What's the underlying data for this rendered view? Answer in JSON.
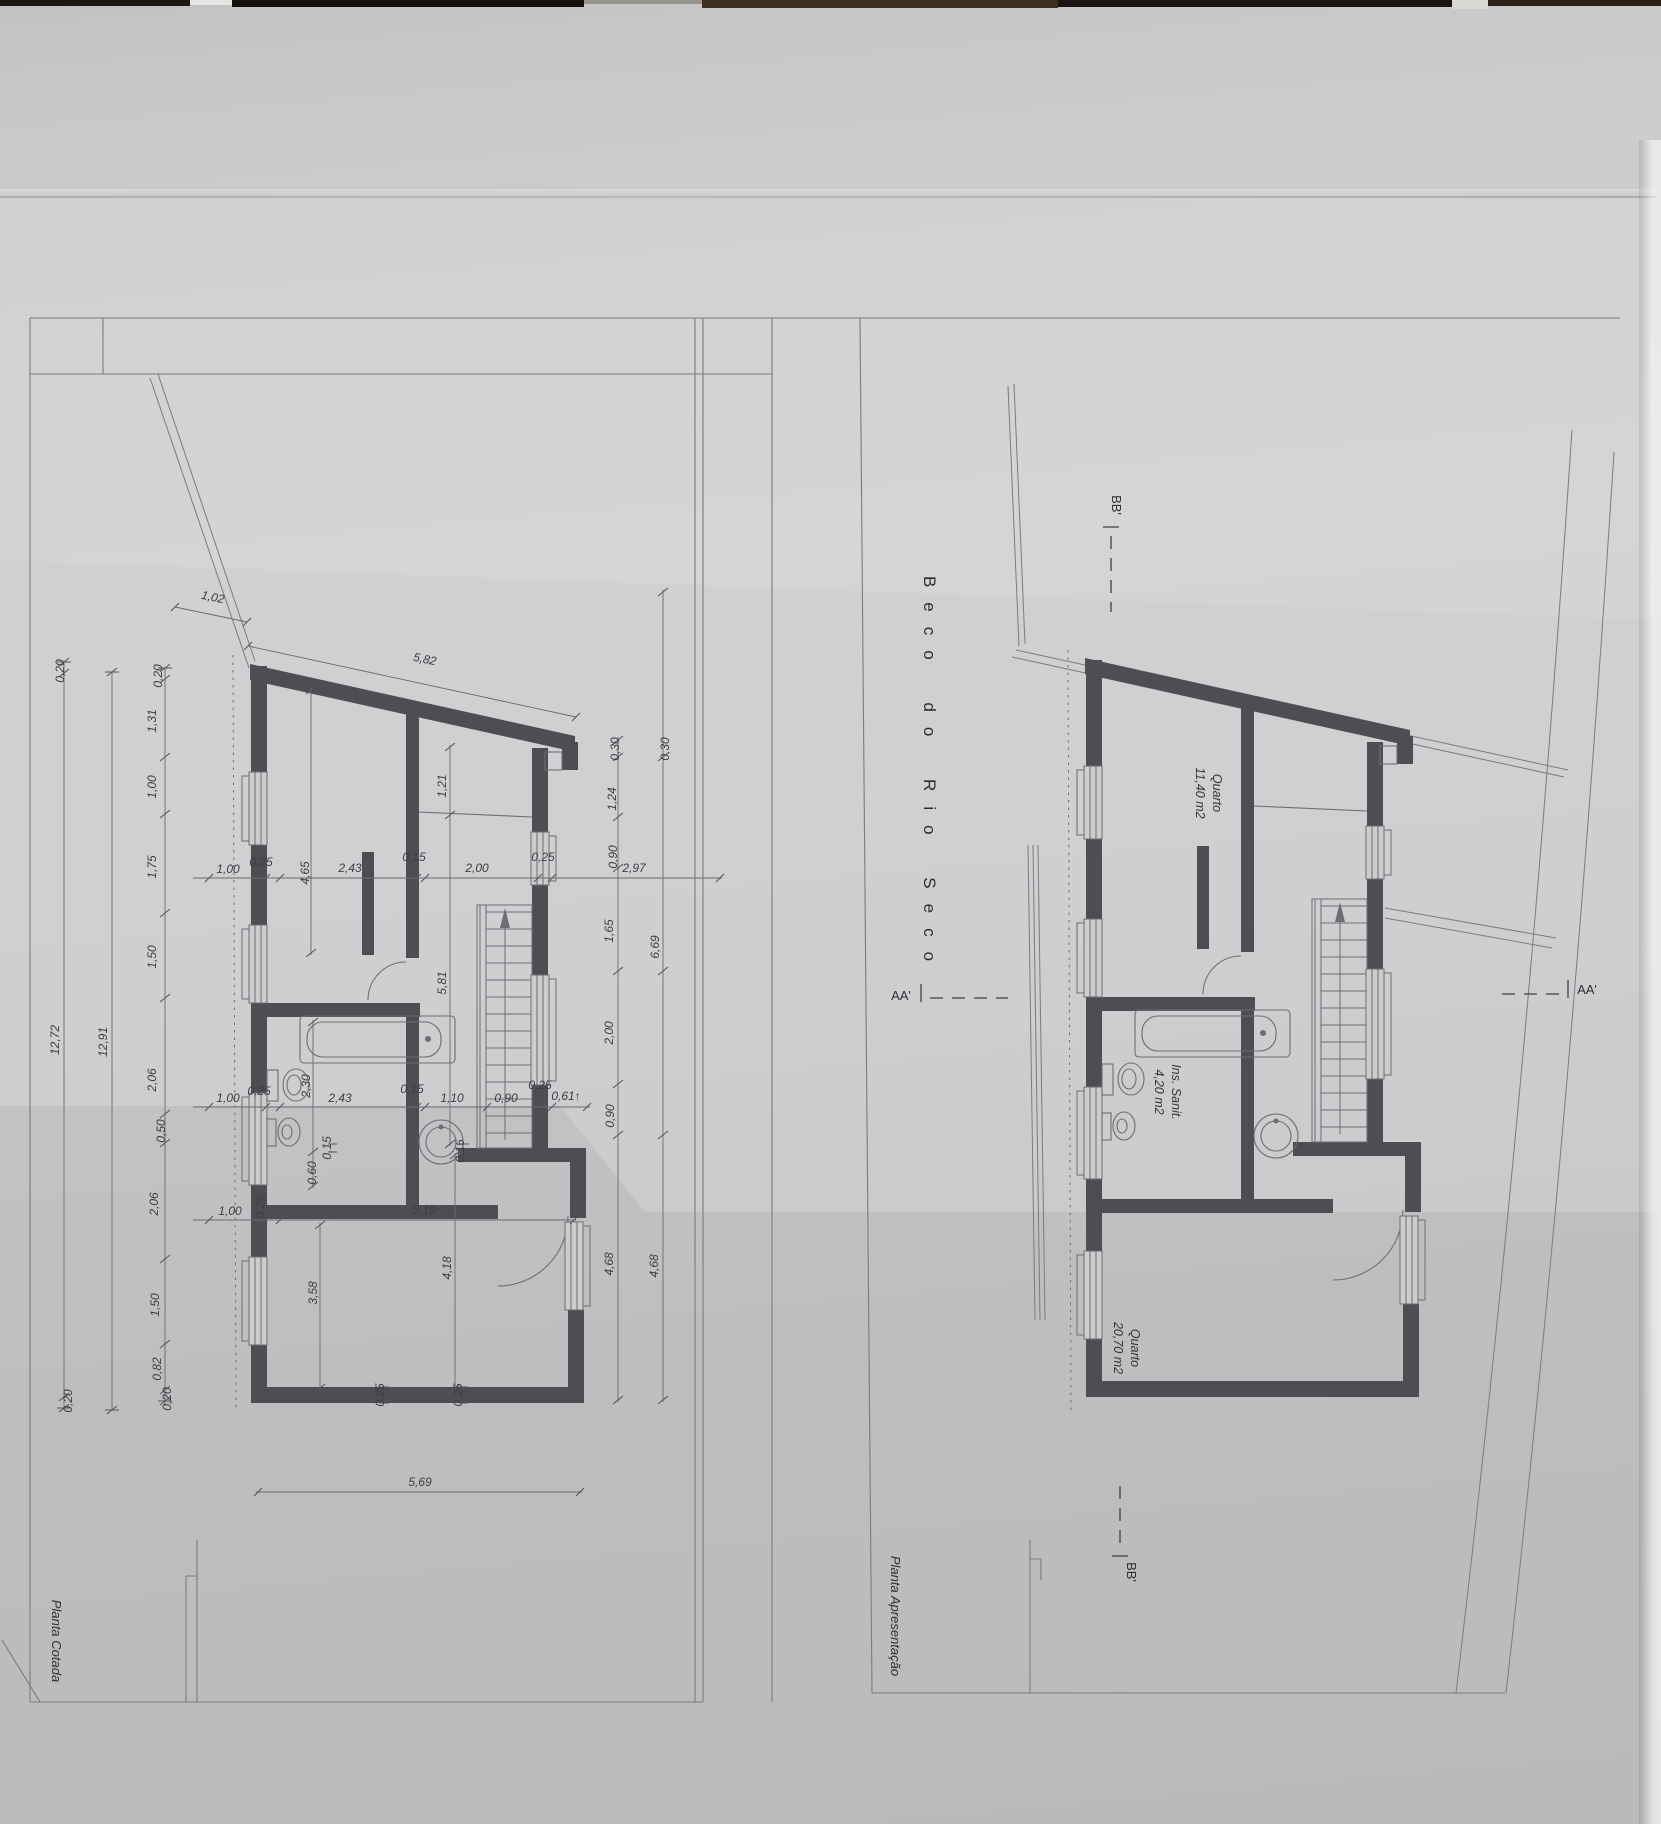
{
  "meta": {
    "street": "Beco do Rio Seco",
    "plan_left_title": "Planta Cotada",
    "plan_right_title": "Planta Apresentação"
  },
  "rooms": [
    {
      "name": "Quarto",
      "area": "11,40 m2"
    },
    {
      "name": "Ins. Sanit.",
      "area": "4,20 m2"
    },
    {
      "name": "Quarto",
      "area": "20,70 m2"
    }
  ],
  "sections": [
    "AA'",
    "BB'"
  ],
  "colors": {
    "paper": "#cdcdcf",
    "wall": "#4d4d52",
    "line": "#6d6d72",
    "dim_line": "#6a6a6f",
    "text": "#3d3d42"
  },
  "dims": [
    {
      "t": "1,02",
      "x": 212,
      "y": 601,
      "r": 12
    },
    {
      "t": "5,82",
      "x": 424,
      "y": 663,
      "r": 12
    },
    {
      "t": "0,20",
      "x": 162,
      "y": 676,
      "r": -90
    },
    {
      "t": "1,31",
      "x": 156,
      "y": 721,
      "r": -90
    },
    {
      "t": "1,00",
      "x": 156,
      "y": 787,
      "r": -90
    },
    {
      "t": "1,75",
      "x": 156,
      "y": 867,
      "r": -90
    },
    {
      "t": "1,50",
      "x": 156,
      "y": 957,
      "r": -90
    },
    {
      "t": "2,06",
      "x": 156,
      "y": 1080,
      "r": -90
    },
    {
      "t": "0,50",
      "x": 165,
      "y": 1131,
      "r": -90
    },
    {
      "t": "2,06",
      "x": 158,
      "y": 1204,
      "r": -90
    },
    {
      "t": "1,50",
      "x": 159,
      "y": 1305,
      "r": -90
    },
    {
      "t": "0,82",
      "x": 161,
      "y": 1369,
      "r": -90
    },
    {
      "t": "0,20",
      "x": 171,
      "y": 1399,
      "r": -90
    },
    {
      "t": "12,91",
      "x": 107,
      "y": 1042,
      "r": -90
    },
    {
      "t": "0,20",
      "x": 64,
      "y": 671,
      "r": -90
    },
    {
      "t": "12,72",
      "x": 59,
      "y": 1040,
      "r": -90
    },
    {
      "t": "0,20",
      "x": 72,
      "y": 1401,
      "r": -90
    },
    {
      "t": "1,00",
      "x": 228,
      "y": 873,
      "r": 0
    },
    {
      "t": "0,25",
      "x": 261,
      "y": 866,
      "r": 0
    },
    {
      "t": "4,65",
      "x": 309,
      "y": 873,
      "r": -90
    },
    {
      "t": "2,43",
      "x": 350,
      "y": 872,
      "r": 0
    },
    {
      "t": "0,15",
      "x": 414,
      "y": 861,
      "r": 0
    },
    {
      "t": "2,00",
      "x": 477,
      "y": 872,
      "r": 0
    },
    {
      "t": "0,25",
      "x": 543,
      "y": 861,
      "r": 0
    },
    {
      "t": "2,97",
      "x": 634,
      "y": 872,
      "r": 0
    },
    {
      "t": "0,30",
      "x": 619,
      "y": 749,
      "r": -90
    },
    {
      "t": "0,30",
      "x": 669,
      "y": 749,
      "r": -90
    },
    {
      "t": "1,24",
      "x": 616,
      "y": 799,
      "r": -90
    },
    {
      "t": "0,90",
      "x": 617,
      "y": 857,
      "r": -90
    },
    {
      "t": "1,65",
      "x": 613,
      "y": 931,
      "r": -90
    },
    {
      "t": "6,69",
      "x": 659,
      "y": 947,
      "r": -90
    },
    {
      "t": "2,00",
      "x": 613,
      "y": 1033,
      "r": -90
    },
    {
      "t": "0,90",
      "x": 614,
      "y": 1116,
      "r": -90
    },
    {
      "t": "4,68",
      "x": 613,
      "y": 1264,
      "r": -90
    },
    {
      "t": "4,68",
      "x": 658,
      "y": 1266,
      "r": -90
    },
    {
      "t": "1,21",
      "x": 446,
      "y": 786,
      "r": -90
    },
    {
      "t": "5,81",
      "x": 446,
      "y": 983,
      "r": -90
    },
    {
      "t": "2,30",
      "x": 310,
      "y": 1086,
      "r": -90
    },
    {
      "t": "0,15",
      "x": 331,
      "y": 1148,
      "r": -90
    },
    {
      "t": "0,60",
      "x": 316,
      "y": 1173,
      "r": -90
    },
    {
      "t": "3,58",
      "x": 317,
      "y": 1293,
      "r": -90
    },
    {
      "t": "4,18",
      "x": 451,
      "y": 1268,
      "r": -90
    },
    {
      "t": "0,15",
      "x": 464,
      "y": 1151,
      "r": -90
    },
    {
      "t": "1,00",
      "x": 228,
      "y": 1102,
      "r": 0
    },
    {
      "t": "0,25",
      "x": 259,
      "y": 1095,
      "r": 0
    },
    {
      "t": "2,43",
      "x": 340,
      "y": 1102,
      "r": 0
    },
    {
      "t": "0,15",
      "x": 412,
      "y": 1093,
      "r": 0
    },
    {
      "t": "1,10",
      "x": 452,
      "y": 1102,
      "r": 0
    },
    {
      "t": "0,90",
      "x": 506,
      "y": 1102,
      "r": 0
    },
    {
      "t": "0,25",
      "x": 540,
      "y": 1089,
      "r": 0
    },
    {
      "t": "0,61↑",
      "x": 566,
      "y": 1100,
      "r": 0
    },
    {
      "t": "1,00",
      "x": 230,
      "y": 1215,
      "r": 0
    },
    {
      "t": "0,25",
      "x": 264,
      "y": 1207,
      "r": -90
    },
    {
      "t": "5,19",
      "x": 424,
      "y": 1214,
      "r": 0
    },
    {
      "t": "0,25",
      "x": 384,
      "y": 1395,
      "r": -90
    },
    {
      "t": "0,25",
      "x": 462,
      "y": 1395,
      "r": -90
    },
    {
      "t": "5,69",
      "x": 420,
      "y": 1486,
      "r": 0
    }
  ],
  "labels": [
    {
      "t": "Beco do Rio Seco",
      "x": 924,
      "y": 776,
      "r": 90,
      "cls": "street",
      "name": "street-name-label"
    },
    {
      "t": "BB'",
      "x": 1112,
      "y": 505,
      "r": 90,
      "cls": "section",
      "name": "section-bb-top-label"
    },
    {
      "t": "BB'",
      "x": 1127,
      "y": 1572,
      "r": 90,
      "cls": "section",
      "name": "section-bb-bottom-label"
    },
    {
      "t": "AA'",
      "x": 901,
      "y": 1000,
      "r": 0,
      "cls": "section",
      "name": "section-aa-left-label"
    },
    {
      "t": "AA'",
      "x": 1587,
      "y": 994,
      "r": 0,
      "cls": "section",
      "name": "section-aa-right-label"
    },
    {
      "t": "Quarto",
      "x": 1213,
      "y": 793,
      "r": 90,
      "cls": "room",
      "name": "room-quarto1-name"
    },
    {
      "t": "11,40 m2",
      "x": 1196,
      "y": 793,
      "r": 90,
      "cls": "room",
      "name": "room-quarto1-area"
    },
    {
      "t": "Ins. Sanit.",
      "x": 1172,
      "y": 1092,
      "r": 90,
      "cls": "room",
      "name": "room-sanit-name"
    },
    {
      "t": "4,20 m2",
      "x": 1155,
      "y": 1092,
      "r": 90,
      "cls": "room",
      "name": "room-sanit-area"
    },
    {
      "t": "Quarto",
      "x": 1131,
      "y": 1348,
      "r": 90,
      "cls": "room",
      "name": "room-quarto2-name"
    },
    {
      "t": "20,70 m2",
      "x": 1114,
      "y": 1348,
      "r": 90,
      "cls": "room",
      "name": "room-quarto2-area"
    },
    {
      "t": "Planta Cotada",
      "x": 52,
      "y": 1641,
      "r": 90,
      "cls": "title",
      "name": "plan-cotada-title"
    },
    {
      "t": "Planta Apresentação",
      "x": 891,
      "y": 1616,
      "r": 90,
      "cls": "title",
      "name": "plan-apresentacao-title"
    }
  ]
}
